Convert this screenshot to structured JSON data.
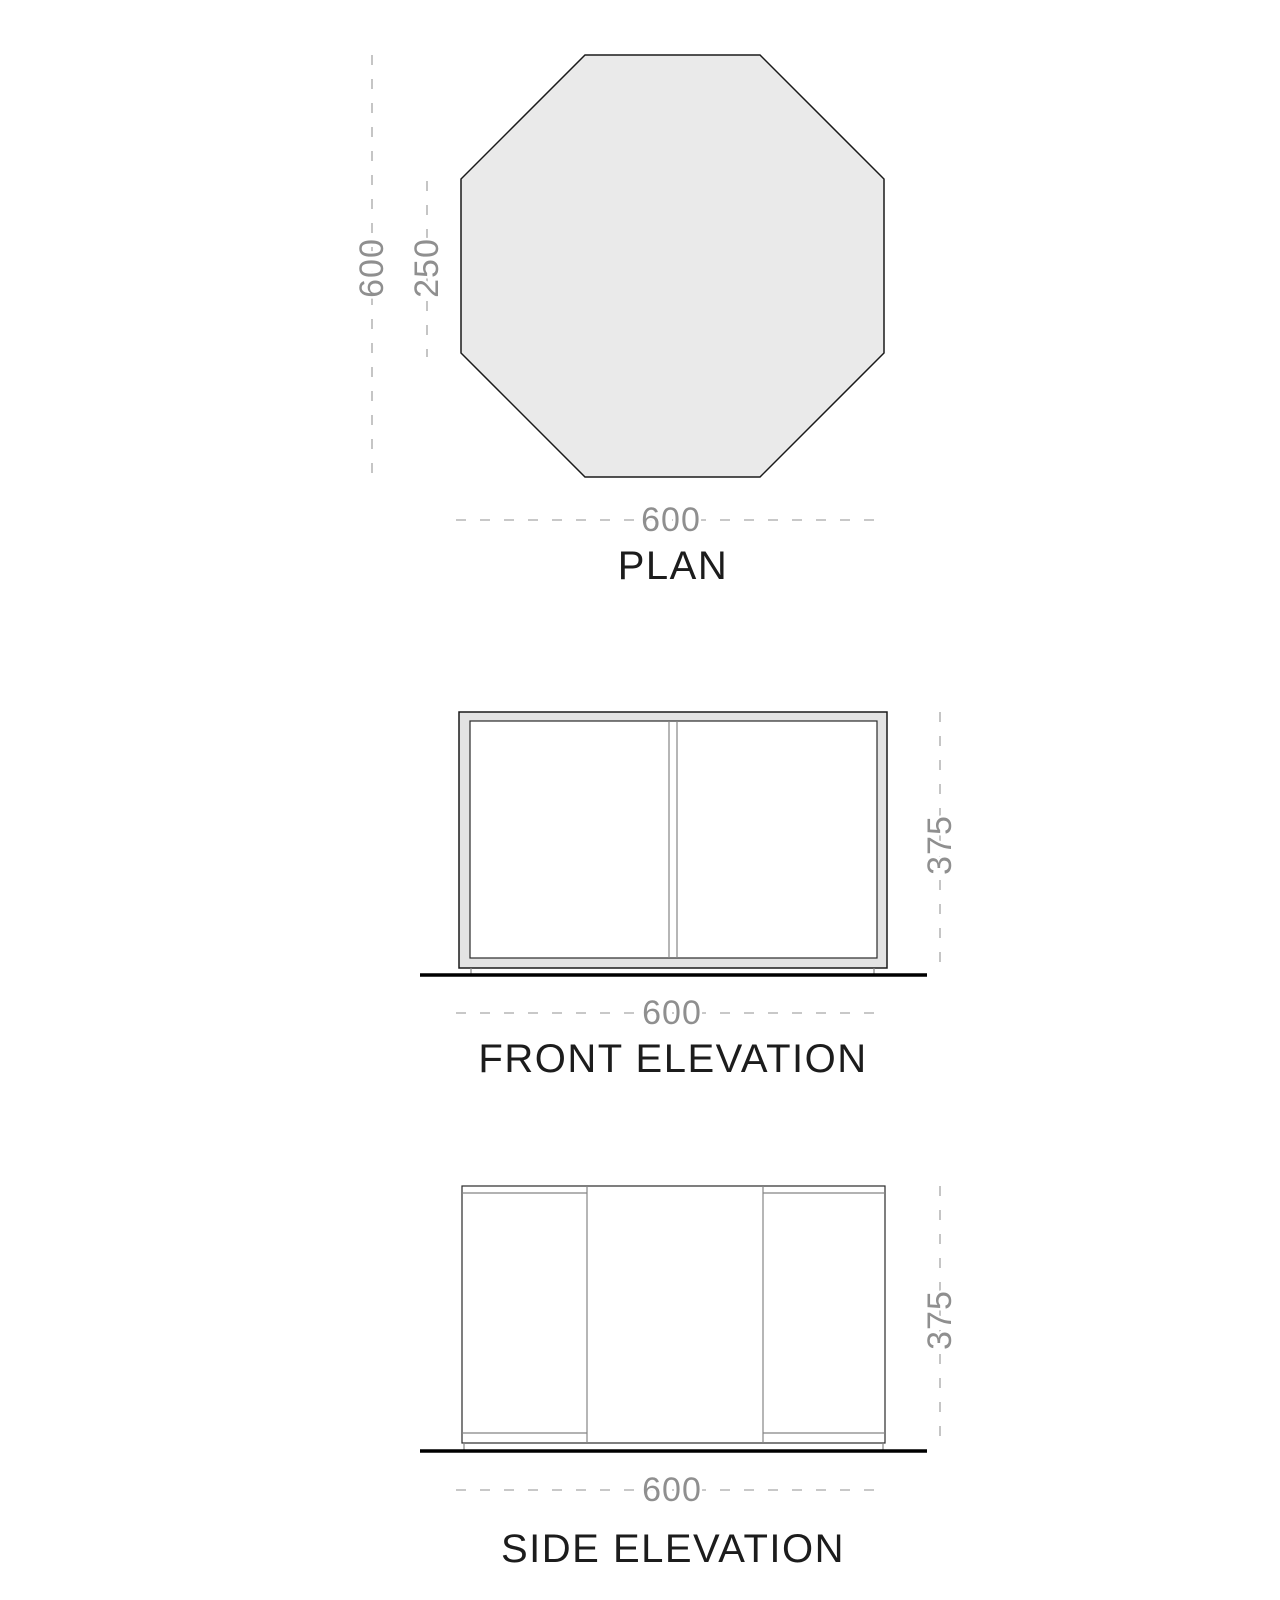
{
  "plan": {
    "title": "PLAN",
    "dim_height_total": "600",
    "dim_edge": "250",
    "dim_width": "600"
  },
  "front": {
    "title": "FRONT ELEVATION",
    "dim_height": "375",
    "dim_width": "600"
  },
  "side": {
    "title": "SIDE ELEVATION",
    "dim_height": "375",
    "dim_width": "600"
  },
  "colors": {
    "surface_fill": "#eaeaea",
    "frame_fill": "#e3e3e3",
    "outline_black": "#1a1a1a",
    "dim_gray": "#8f8f8f",
    "dash_gray": "#a6a6a6",
    "ground_black": "#000000",
    "background": "#ffffff"
  }
}
